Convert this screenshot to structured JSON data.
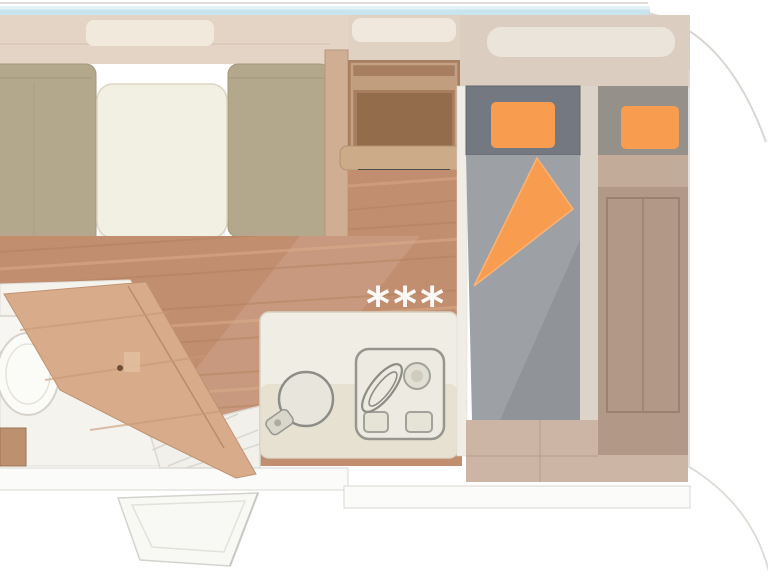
{
  "floor_plan": {
    "marker": "***",
    "palette": {
      "floor_wood": "#c28e70",
      "bench": "#b3a88c",
      "table": "#f2efe3",
      "locker_band": "#e4d4c5",
      "headboard_band": "#dbcec0",
      "cabinet_wood": "#a77f60",
      "dark_unit": "#4a4a47",
      "counter": "#f0ede4",
      "mattress": "#9da0a5",
      "headbox_dark": "#747880",
      "headbox_light": "#95918a",
      "accent_orange": "#f89d50",
      "bed_wood": "#b19887",
      "sideboard": "#ccb5a4",
      "door_wood": "#d8ab8a",
      "bath_floor": "#f4f3ee",
      "wall_cyan": "#c8e4ec",
      "marker_white": "#ffffff"
    }
  }
}
